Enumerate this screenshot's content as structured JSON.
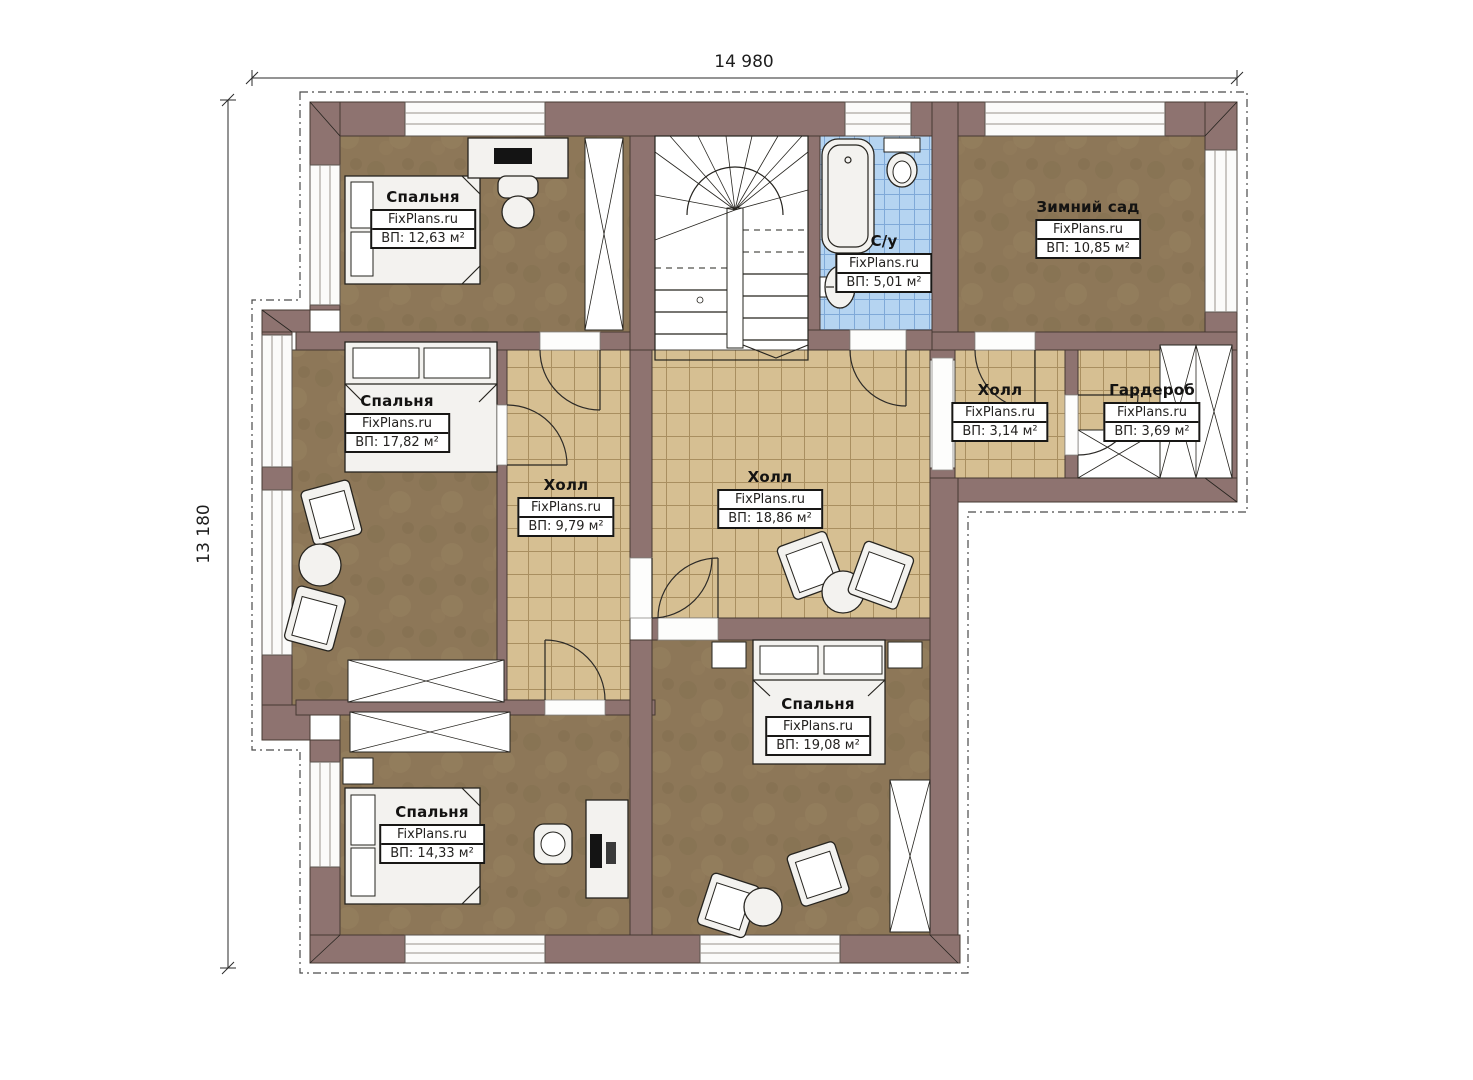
{
  "meta": {
    "type": "floor-plan",
    "floor": "second-floor"
  },
  "brand": "FixPlans.ru",
  "dimensions": {
    "width": "14 980",
    "height": "13 180"
  },
  "colors": {
    "background": "#ffffff",
    "wall": "#8e7370",
    "bedroom_floor": "#8d7758",
    "tile_floor": "#d6bf92",
    "bath_tile": "#b5d4f1",
    "line": "#26241f"
  },
  "rooms": [
    {
      "key": "bedroom-top-left",
      "name": "Спальня",
      "brand": "FixPlans.ru",
      "area": "ВП: 12,63 м²"
    },
    {
      "key": "winter-garden",
      "name": "Зимний сад",
      "brand": "FixPlans.ru",
      "area": "ВП: 10,85 м²"
    },
    {
      "key": "bathroom",
      "name": "С/у",
      "brand": "FixPlans.ru",
      "area": "ВП: 5,01 м²"
    },
    {
      "key": "bedroom-left",
      "name": "Спальня",
      "brand": "FixPlans.ru",
      "area": "ВП: 17,82 м²"
    },
    {
      "key": "hall-small",
      "name": "Холл",
      "brand": "FixPlans.ru",
      "area": "ВП: 9,79 м²"
    },
    {
      "key": "hall-main",
      "name": "Холл",
      "brand": "FixPlans.ru",
      "area": "ВП: 18,86 м²"
    },
    {
      "key": "hall-right",
      "name": "Холл",
      "brand": "FixPlans.ru",
      "area": "ВП: 3,14 м²"
    },
    {
      "key": "wardrobe-room",
      "name": "Гардероб",
      "brand": "FixPlans.ru",
      "area": "ВП: 3,69 м²"
    },
    {
      "key": "bedroom-bottom-center",
      "name": "Спальня",
      "brand": "FixPlans.ru",
      "area": "ВП: 19,08 м²"
    },
    {
      "key": "bedroom-bottom-left",
      "name": "Спальня",
      "brand": "FixPlans.ru",
      "area": "ВП: 14,33 м²"
    }
  ]
}
